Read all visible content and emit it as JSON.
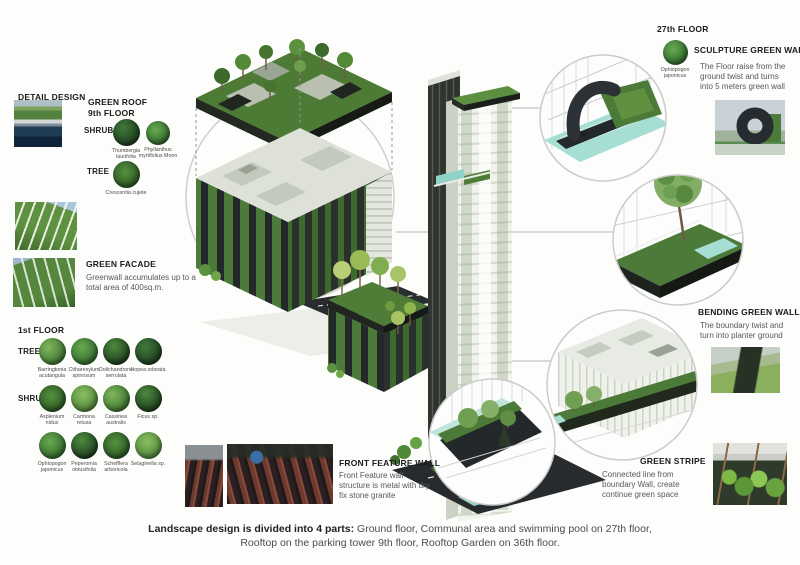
{
  "colors": {
    "accent_green": "#4c7a38",
    "dark_mass": "#23282b",
    "pool_teal": "#9fd8ce",
    "heading_text": "#1b1b1b",
    "body_text": "#585858"
  },
  "detail_design": {
    "title": "DETAIL DESIGN"
  },
  "green_roof": {
    "title_line1": "GREEN ROOF",
    "title_line2": "9th FLOOR",
    "shrub_label": "SHRUB",
    "tree_label": "TREE",
    "shrubs": [
      "Thumbergia laurifolia",
      "Phyllanthus myrtifolius Moon"
    ],
    "trees": [
      "Crescentia cujete"
    ]
  },
  "green_facade": {
    "title": "GREEN FACADE",
    "description": "Greenwall accumulates up to a total area of 400sq.m."
  },
  "first_floor": {
    "title": "1st FLOOR",
    "tree_label": "TREE",
    "shrub_label": "SHRUB",
    "trees": [
      "Barringtonia acutangula",
      "Citharexylum spinosum",
      "Dolichandrone serrulata",
      "Hopea odorata"
    ],
    "shrubs_row1": [
      "Asplenium nidus",
      "Carmona retusa",
      "Cassinea australis",
      "Ficus sp."
    ],
    "shrubs_row2": [
      "Ophiopogon japonicus",
      "Peperomia obtusifolia",
      "Schefflera arboricola",
      "Selaginella sp."
    ]
  },
  "floor_27": {
    "title": "27th FLOOR",
    "plant": "Ophiopogon japonicus",
    "sculpture_title": "SCULPTURE GREEN WALL",
    "sculpture_description": "The Floor raise from the ground twist and turns into 5 meters green wall"
  },
  "bending_green_wall": {
    "title": "BENDING GREEN WALL",
    "description": "The boundary twist and turn into planter ground"
  },
  "green_stripe": {
    "title": "GREEN STRIPE",
    "description": "Connected line from boundary Wall, create continue green space"
  },
  "front_feature_wall": {
    "title": "FRONT FEATURE WALL",
    "description": "Front Feature wall structure is metal with dry fix stone granite"
  },
  "caption": {
    "lead": "Landscape design is divided into 4 parts:",
    "line1_rest": " Ground floor, Communal area and swimming pool on 27th floor,",
    "line2": "Rooftop on the parking tower 9th floor, Rooftop Garden on 36th floor."
  }
}
